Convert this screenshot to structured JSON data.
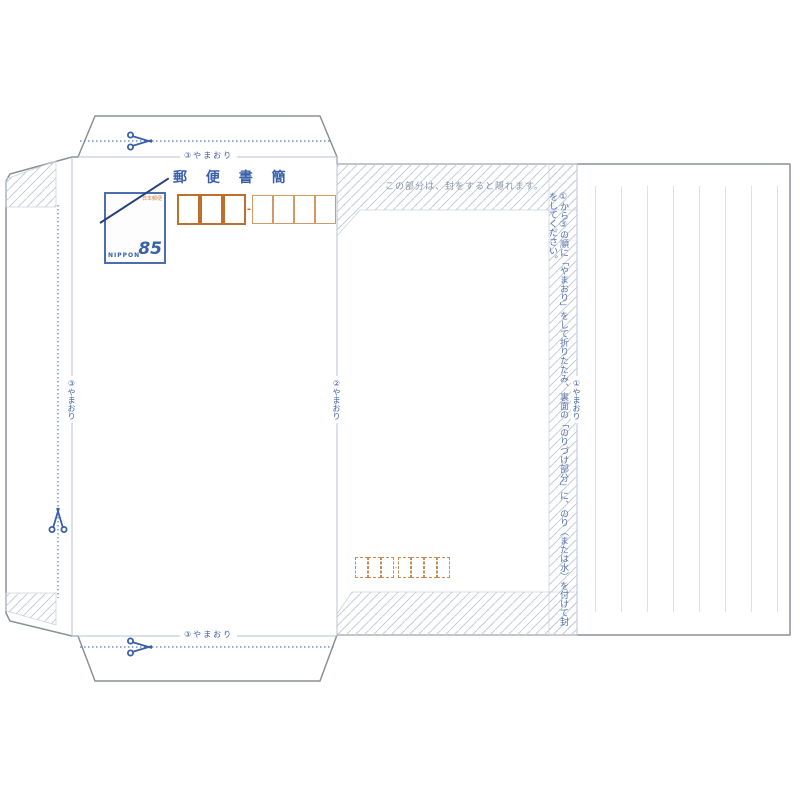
{
  "document": {
    "type_note": "Japanese letter sheet (mini letter) printing template",
    "title": "郵 便 書 簡",
    "stamp": {
      "issuer": "日本郵便",
      "value": "85",
      "country": "NIPPON",
      "design": "paper airplanes"
    },
    "postal_code_recipient": {
      "group1_count": 3,
      "group2_count": 4,
      "separator": "-"
    },
    "postal_code_sender": {
      "group1_count": 3,
      "group2_count": 4,
      "separator": "-"
    },
    "hidden_note": "この部分は、封をすると隠れます。",
    "instructions": "①から③の順に「やまおり」をして折りたたみ、裏面の「のりづけ部分」に、のり（または水）を付けて封をしてください。",
    "fold_labels": {
      "top": "③やまおり",
      "bottom": "③やまおり",
      "left": "③やまおり",
      "middle": "②やまおり",
      "right": "①やまおり"
    },
    "writing_panel": {
      "ruled_line_count": 8,
      "orientation": "vertical"
    },
    "colors": {
      "blue": "#3a61a7",
      "line_blue": "#b9c3d3",
      "outline_gray": "#8b9199",
      "hatch": "#c4cdda",
      "orange_thick": "#bf6f2d",
      "orange_thin": "#d39a63",
      "note_gray": "#8c95a5",
      "instruction_blue": "#5873ab",
      "ruled_line": "#dbe0e9"
    }
  }
}
